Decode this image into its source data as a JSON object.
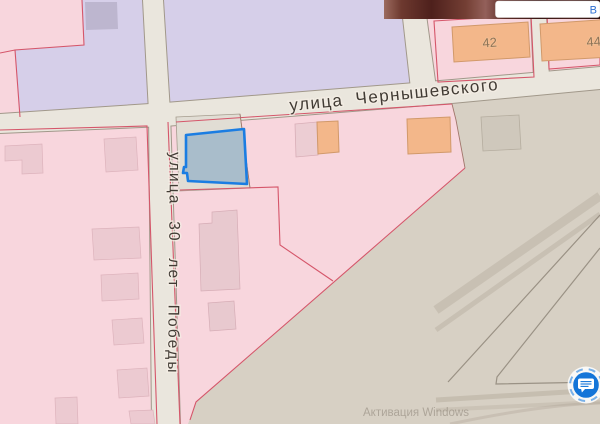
{
  "map": {
    "streets": [
      {
        "name": "chernyshevskogo",
        "label": "улица Чернышевского"
      },
      {
        "name": "30-let-pobedy",
        "label": "улица 30 лет Победы"
      }
    ],
    "buildings": [
      {
        "number": "42"
      },
      {
        "number": "44"
      }
    ],
    "selected_plot": {
      "stroke_color": "#1b7de2",
      "fill_color": "#a9bdcb"
    },
    "colors": {
      "residential_pink": "#f8d6dd",
      "civic_purple": "#d6cfe9",
      "industrial_gray": "#d7d0c4",
      "road_fill": "#eae6dd",
      "cadastral_red": "#d5566a",
      "building_orange": "#f3b78a"
    }
  },
  "overlay": {
    "watermark_line1": "Активация Windows",
    "account_link": "В",
    "chat_button_color": "#1475d8"
  }
}
